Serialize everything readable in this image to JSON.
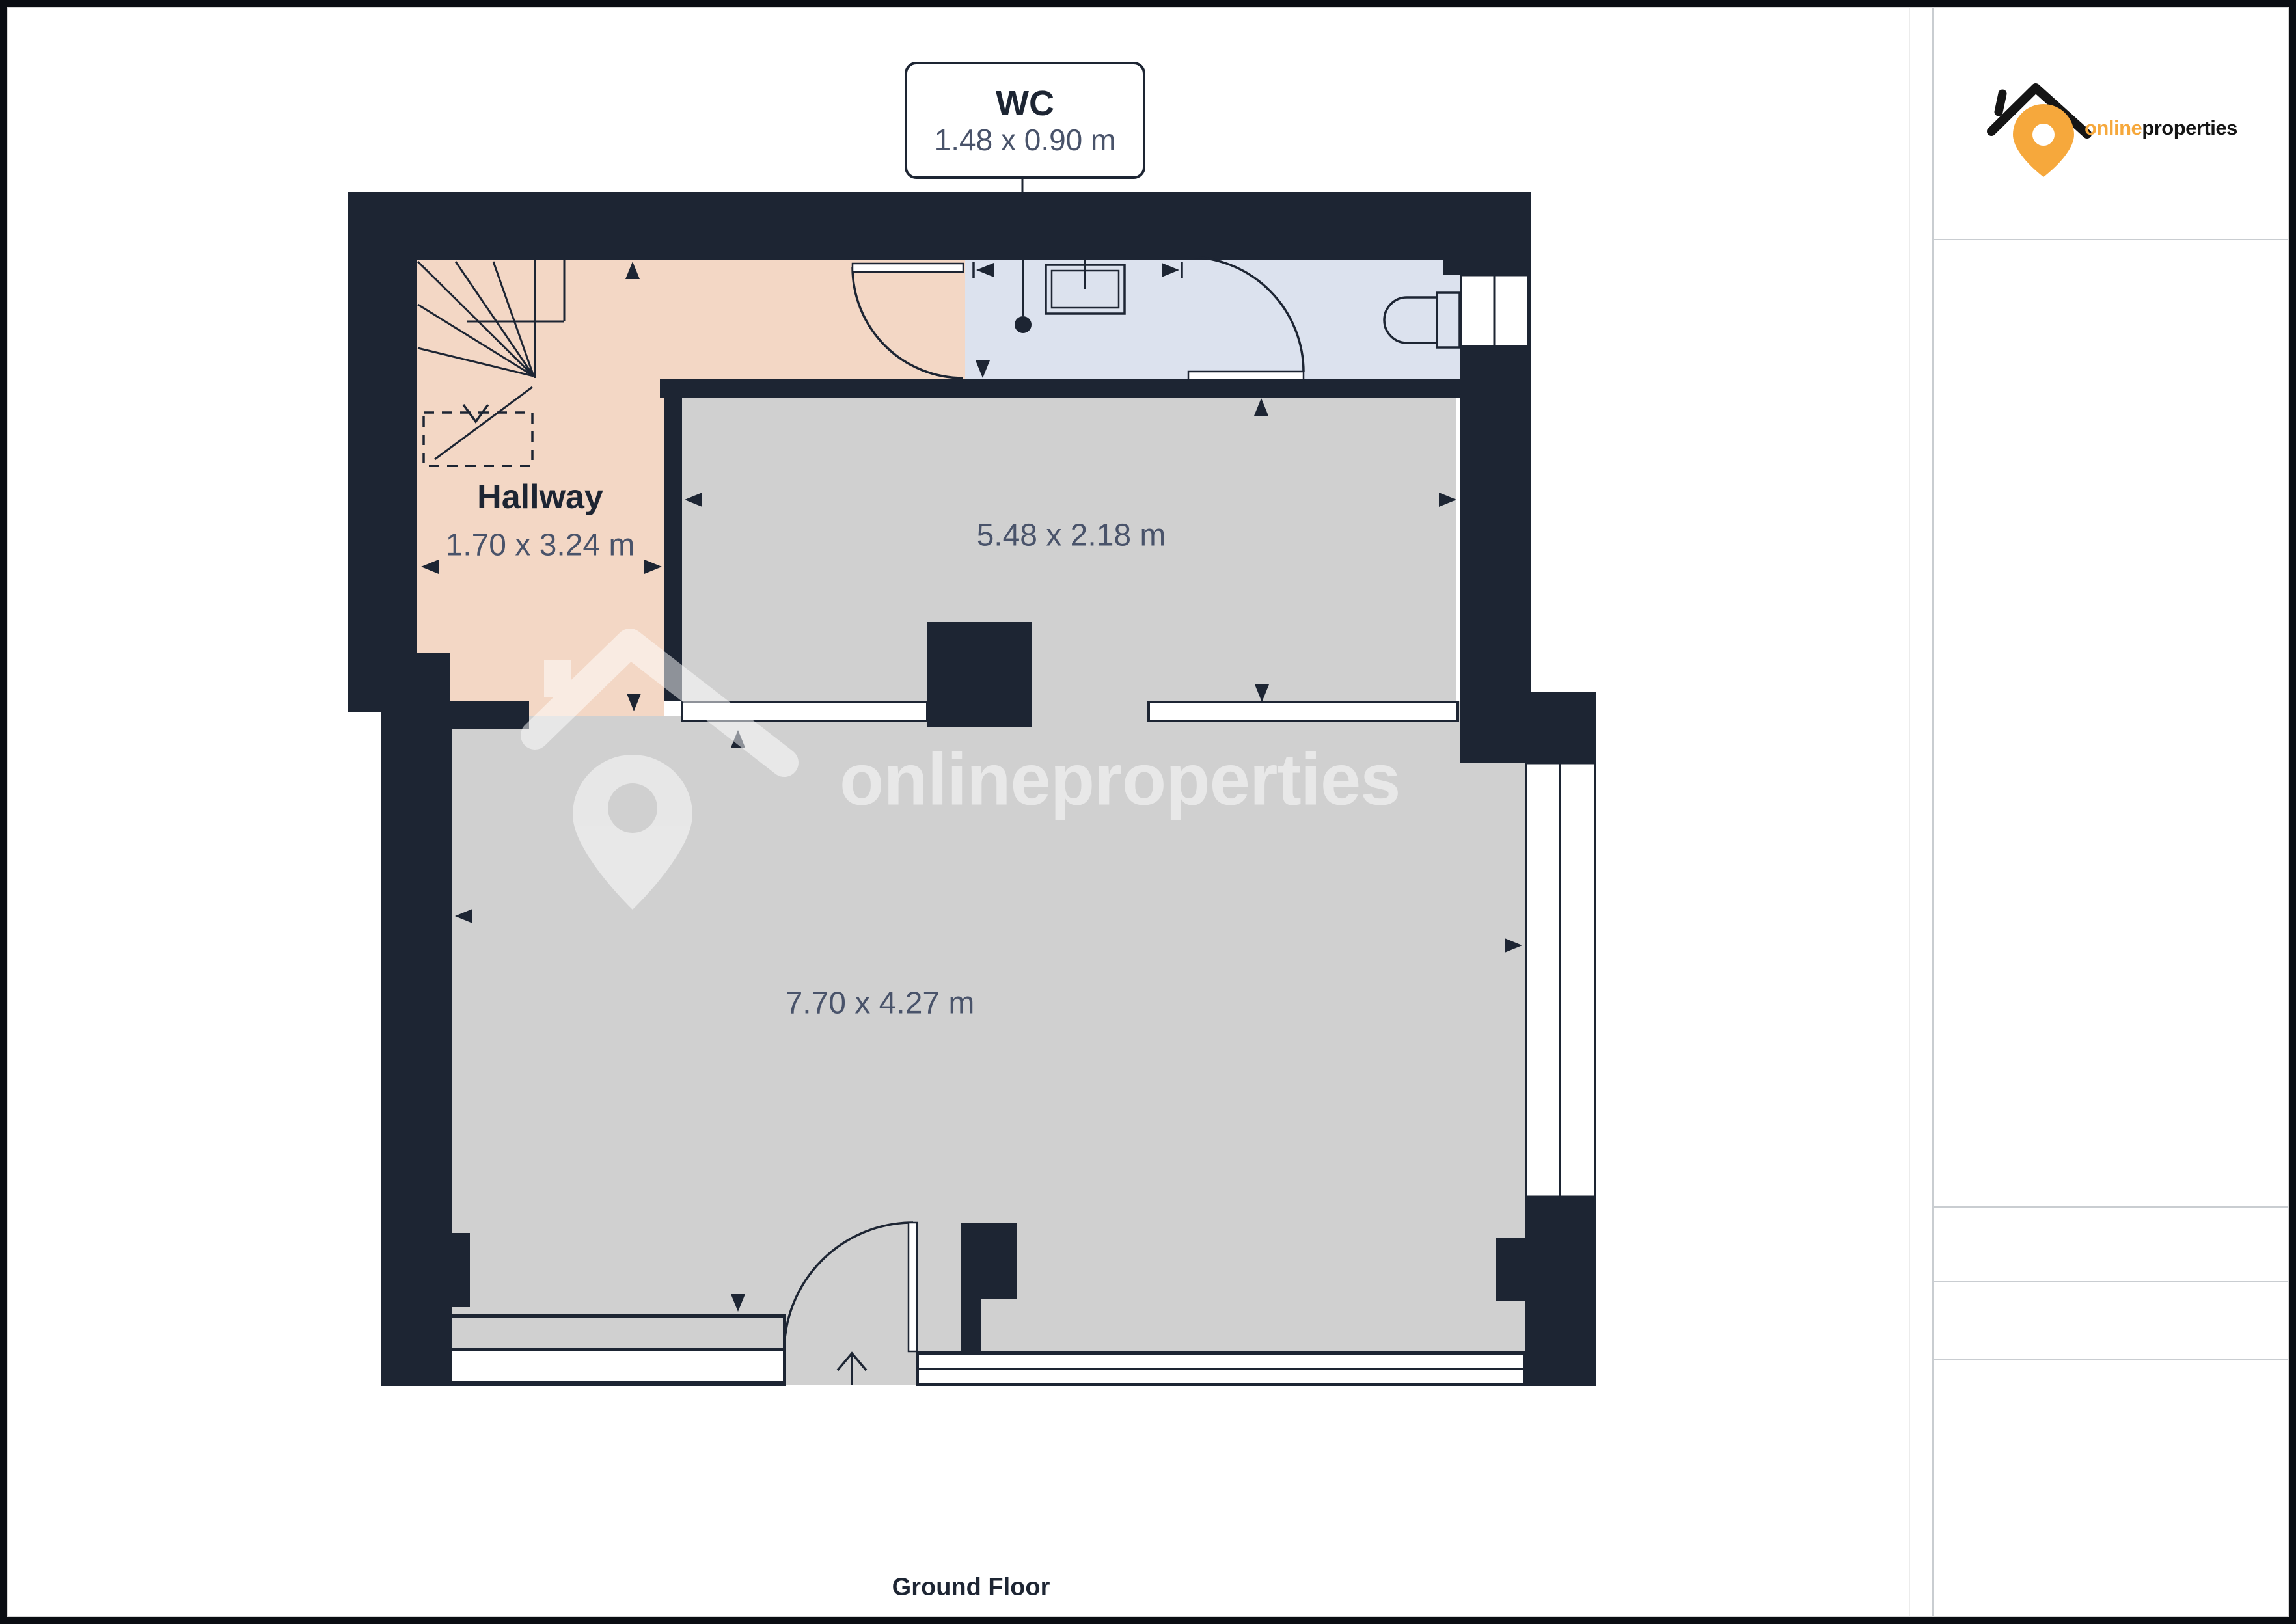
{
  "branding": {
    "name_primary": "online",
    "name_secondary": "properties",
    "accent_color": "#F6A83C",
    "text_color": "#151515",
    "logo_icon": "house-roof-with-location-pin"
  },
  "watermark": {
    "text": "onlineproperties"
  },
  "plan": {
    "floor_label": "Ground Floor",
    "rooms": {
      "wc": {
        "name": "WC",
        "dimensions": "1.48 x 0.90 m"
      },
      "hallway": {
        "name": "Hallway",
        "dimensions": "1.70 x 3.24 m"
      },
      "room_top": {
        "dimensions": "5.48 x 2.18 m"
      },
      "room_main": {
        "dimensions": "7.70 x 4.27 m"
      }
    }
  },
  "colors": {
    "wall": "#1D2533",
    "hallway_floor": "#F3D7C5",
    "wc_floor": "#DCE2EE",
    "room_floor": "#D0D0D0",
    "dimension_text": "#49536A",
    "frame": "#0A0D12",
    "sidebar_divider": "#C9CDD1"
  }
}
